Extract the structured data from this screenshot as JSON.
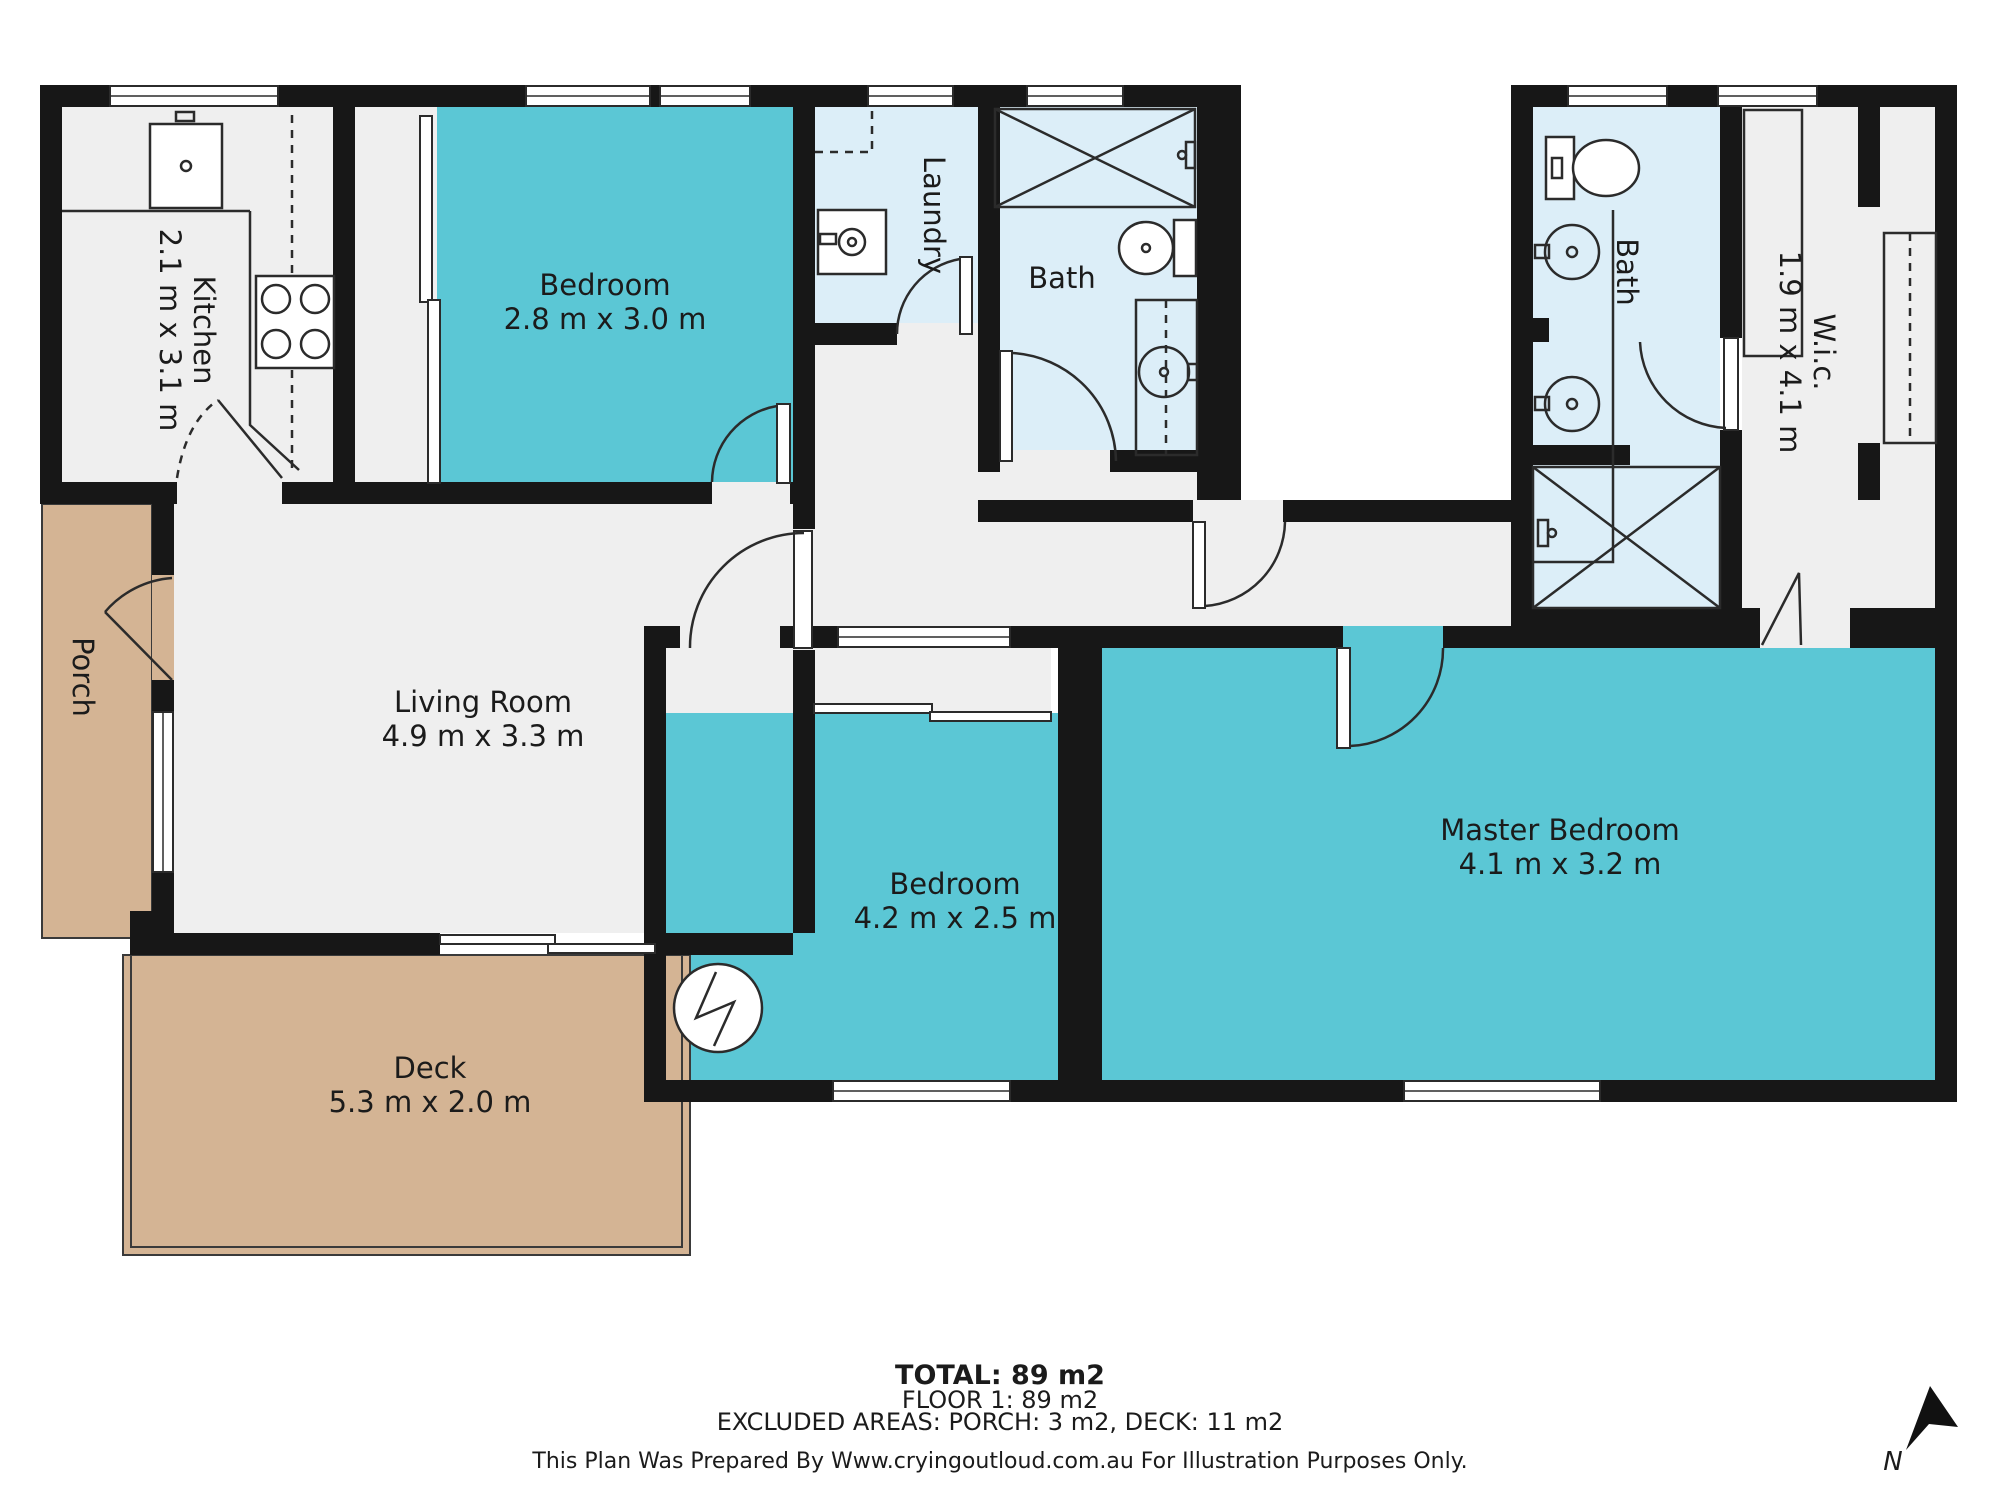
{
  "plan": {
    "rooms": {
      "kitchen": {
        "name": "Kitchen",
        "dims": "2.1 m x 3.1 m"
      },
      "bedroom1": {
        "name": "Bedroom",
        "dims": "2.8 m x 3.0 m"
      },
      "laundry": {
        "name": "Laundry"
      },
      "bath1": {
        "name": "Bath"
      },
      "bath2": {
        "name": "Bath"
      },
      "wic": {
        "name": "W.i.c.",
        "dims": "1.9 m x 4.1 m"
      },
      "living": {
        "name": "Living Room",
        "dims": "4.9 m x 3.3 m"
      },
      "bedroom2": {
        "name": "Bedroom",
        "dims": "4.2 m x 2.5 m"
      },
      "master": {
        "name": "Master Bedroom",
        "dims": "4.1 m x 3.2 m"
      },
      "porch": {
        "name": "Porch"
      },
      "deck": {
        "name": "Deck",
        "dims": "5.3 m x 2.0 m"
      }
    },
    "footer": {
      "total": "TOTAL: 89 m2",
      "floor": "FLOOR 1: 89 m2",
      "excluded": "EXCLUDED AREAS: PORCH: 3 m2, DECK: 11 m2",
      "disclaimer": "This Plan Was Prepared By Www.cryingoutloud.com.au For Illustration Purposes Only."
    },
    "compass": {
      "label": "N"
    },
    "colors": {
      "wall": "#171717",
      "room": "#efefef",
      "wet": "#dceef8",
      "highlight": "#5bc7d5",
      "outdoor": "#d4b494",
      "text": "#1b1b1b"
    }
  }
}
